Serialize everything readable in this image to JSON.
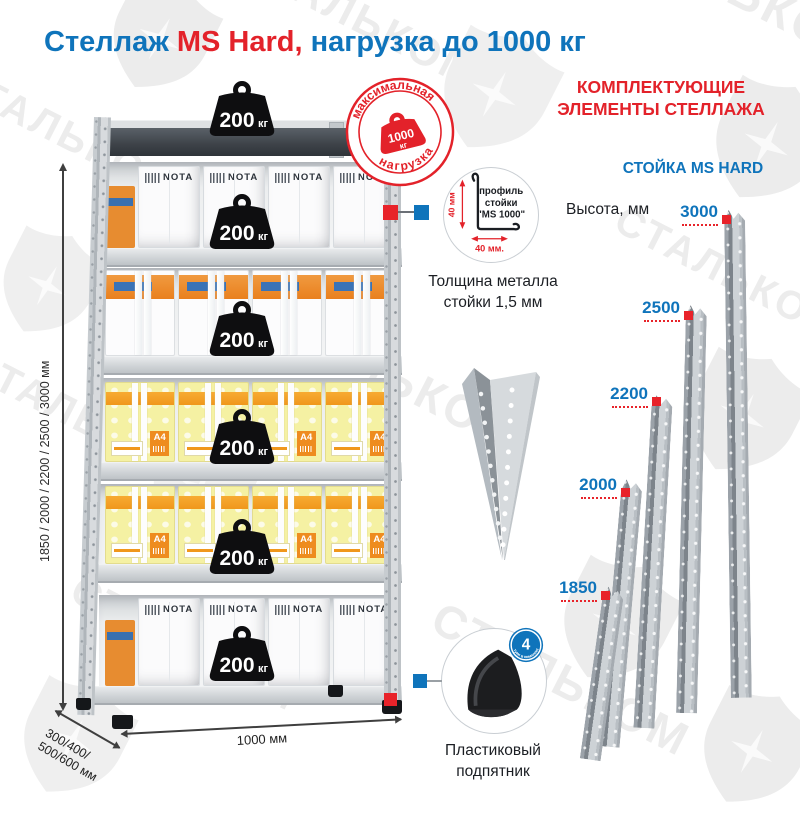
{
  "page": {
    "title_blue1": "Стеллаж ",
    "title_red": "MS Hard,",
    "title_blue2": " нагрузка до 1000 кг"
  },
  "watermark": {
    "brand": "СТАЛЬКОМ"
  },
  "stamp": {
    "arc_top": "максимальная",
    "arc_bottom": "нагрузка",
    "weight_value": "1000",
    "weight_unit": "кг"
  },
  "rack": {
    "load_value": "200",
    "load_unit": "кг",
    "box_brand": "NOTA",
    "box_paper_label": "A4"
  },
  "dims": {
    "heights": "1850 / 2000 / 2200 / 2500 / 3000 мм",
    "depth_line1": "300/400/",
    "depth_line2": "500/600 мм",
    "width": "1000 мм"
  },
  "profile_detail": {
    "line1": "профиль",
    "line2": "стойки",
    "line3": "\"MS 1000\"",
    "dim_vertical": "40 мм",
    "dim_horizontal": "40 мм.",
    "caption_line1": "Толщина металла",
    "caption_line2": "стойки 1,5 мм"
  },
  "foot_detail": {
    "badge_value": "4",
    "badge_text": "штуки в комплекте",
    "caption_line1": "Пластиковый",
    "caption_line2": "подпятник"
  },
  "components": {
    "heading_line1": "КОМПЛЕКТУЮЩИЕ",
    "heading_line2": "ЭЛЕМЕНТЫ СТЕЛЛАЖА",
    "subheading": "СТОЙКА MS HARD",
    "height_label": "Высота, мм",
    "posts": [
      {
        "height": "3000"
      },
      {
        "height": "2500"
      },
      {
        "height": "2200"
      },
      {
        "height": "2000"
      },
      {
        "height": "1850"
      }
    ]
  },
  "colors": {
    "blue": "#0f74bb",
    "red": "#e3222a",
    "steel_light": "#d6dadd",
    "steel_dark": "#8b9298",
    "box_yellow": "#f5f1a3",
    "box_orange": "#ee8c1f"
  }
}
